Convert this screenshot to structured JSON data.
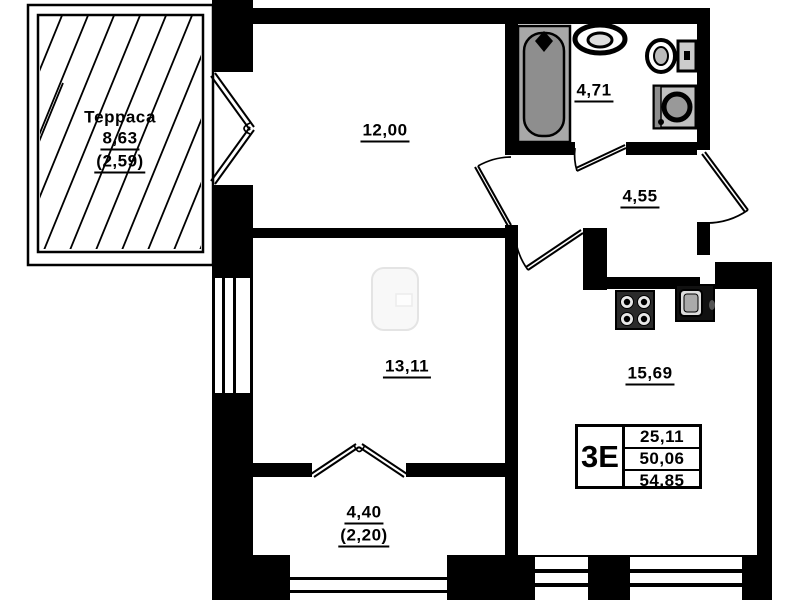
{
  "plan": {
    "terrace": {
      "name": "Терраса",
      "area": "8,63",
      "secondary_area": "(2,59)"
    },
    "rooms": [
      {
        "id": "room-12",
        "area": "12,00"
      },
      {
        "id": "bathroom",
        "area": "4,71"
      },
      {
        "id": "hallway",
        "area": "4,55"
      },
      {
        "id": "room-13",
        "area": "13,11"
      },
      {
        "id": "kitchen-living",
        "area": "15,69"
      },
      {
        "id": "balcony",
        "area": "4,40",
        "secondary_area": "(2,20)"
      }
    ],
    "info_table": {
      "type": "3Е",
      "rows": [
        "25,11",
        "50,06",
        "54,85"
      ]
    },
    "colors": {
      "wall": "#000000",
      "tub": "#8e8e8e",
      "fixture": "#c0c0c0"
    }
  }
}
